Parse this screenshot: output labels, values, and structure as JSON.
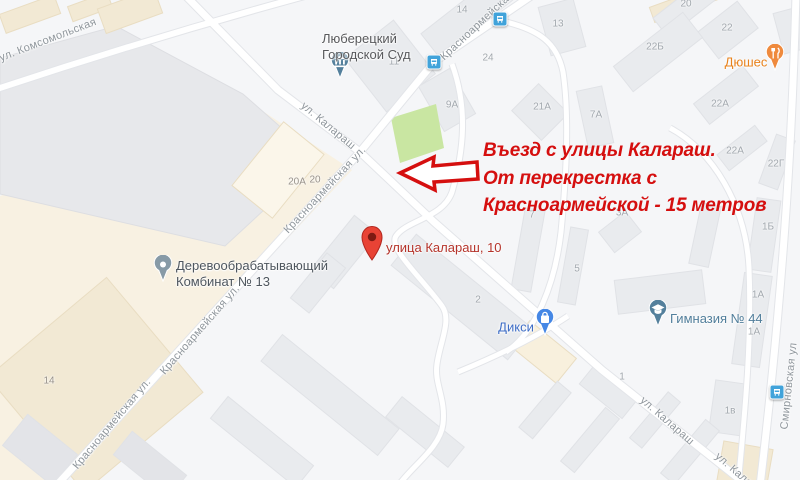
{
  "map": {
    "street_labels": [
      {
        "text": "ул. Комсомольская"
      },
      {
        "text": "Красноармейская"
      },
      {
        "text": "ул. Калараш"
      },
      {
        "text": "Красноармейская ул."
      },
      {
        "text": "Красноармейская ул."
      },
      {
        "text": "Красноармейская ул."
      },
      {
        "text": "ул. Калараш"
      },
      {
        "text": "ул. Калараш"
      },
      {
        "text": "Смирновская ул"
      }
    ],
    "building_numbers": [
      "14",
      "24",
      "11",
      "13",
      "9А",
      "21А",
      "7А",
      "20",
      "22",
      "22Б",
      "22А",
      "22А",
      "22Г",
      "20А",
      "20",
      "7",
      "3А",
      "5",
      "2",
      "1Б",
      "1А",
      "1А",
      "1в",
      "1",
      "14"
    ],
    "pois": {
      "court": {
        "line1": "Люберецкий",
        "line2": "Городской Суд"
      },
      "factory": {
        "line1": "Деревообрабатывающий",
        "line2": "Комбинат № 13"
      },
      "diksi": {
        "label": "Дикси"
      },
      "gymnasium": {
        "label": "Гимназия № 44"
      },
      "dushes": {
        "label": "Дюшес"
      },
      "address_marker": {
        "label": "улица Калараш, 10"
      }
    },
    "annotation": {
      "line1": "Въезд с улицы Калараш.",
      "line2": "От перекрестка с",
      "line3": "Красноармейской - 15 метров"
    },
    "colors": {
      "annotation_red": "#d50f0f",
      "pin_red": "#e84335",
      "pin_red_dot": "#7e1a12",
      "address_label_red": "#b5342b",
      "poi_steel": "#54809c",
      "poi_gray": "#879aa6",
      "poi_blue": "#4587e5",
      "poi_orange": "#ef8a3d",
      "bus_blue": "#41a3da",
      "park_green": "#c9e6a2",
      "road_white": "#ffffff"
    }
  }
}
